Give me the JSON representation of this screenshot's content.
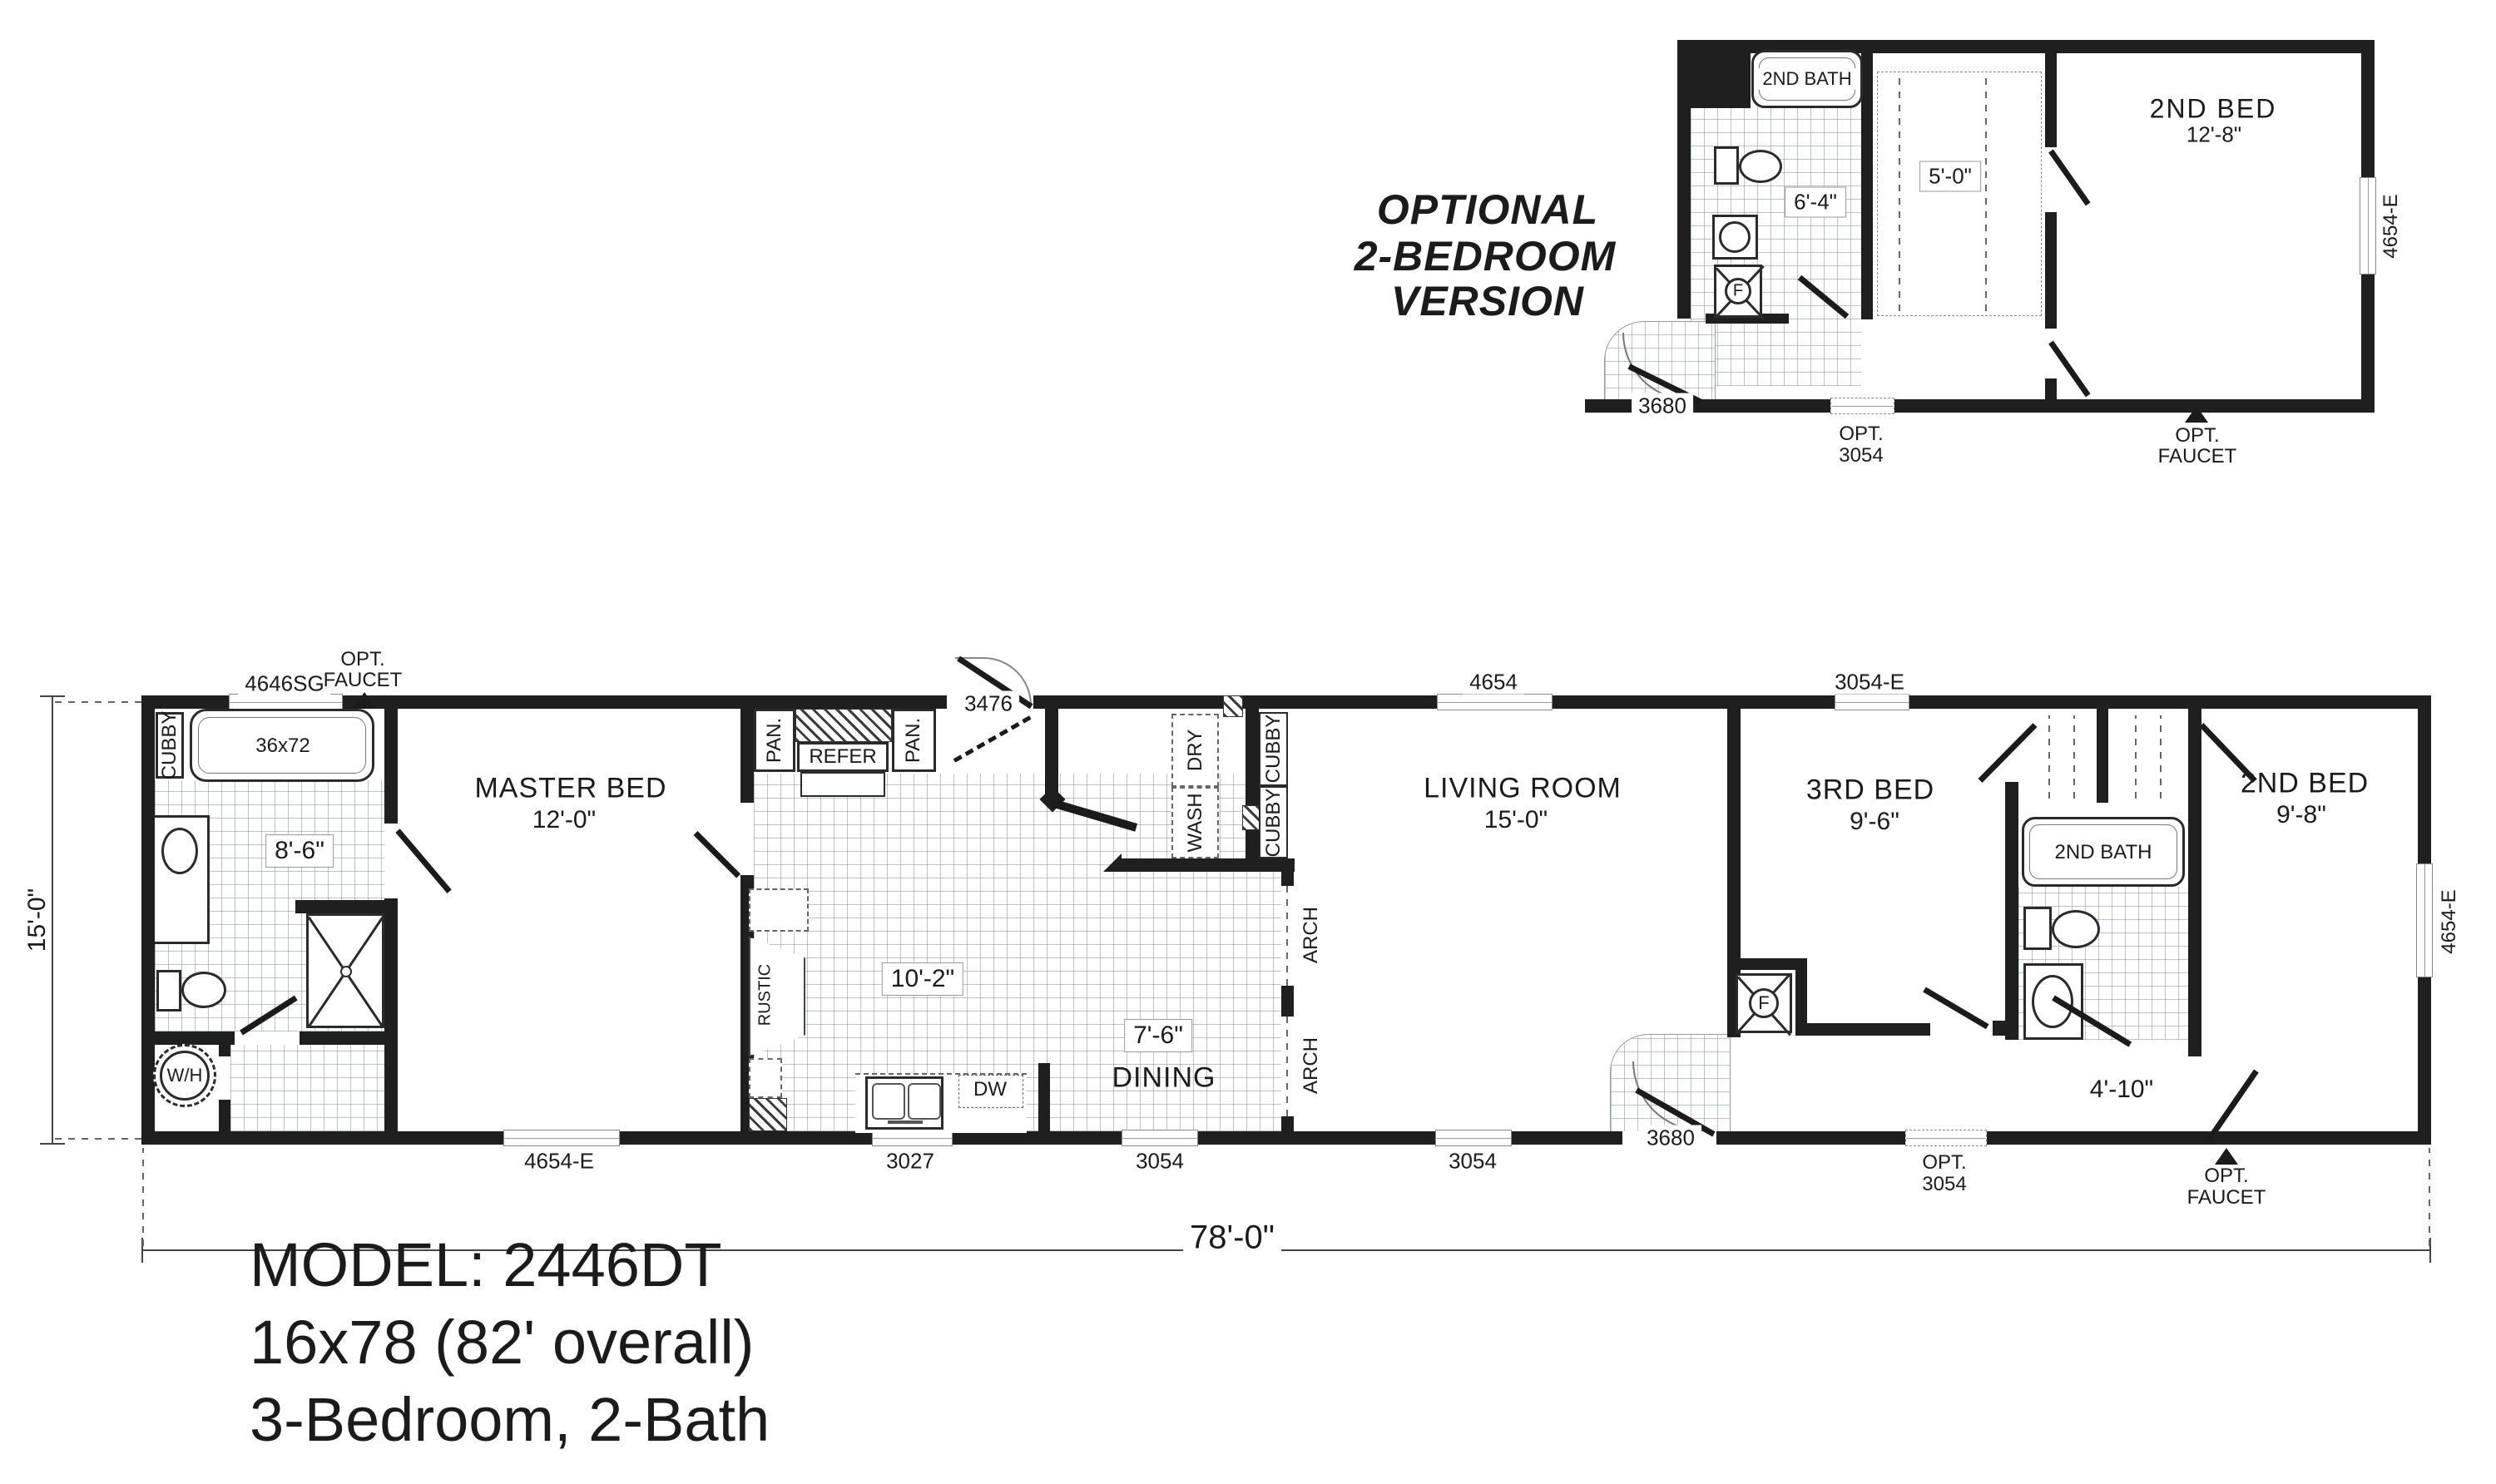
{
  "title": {
    "line1": "MODEL: 2446DT",
    "line2": "16x78 (82' overall)",
    "line3": "3-Bedroom, 2-Bath"
  },
  "optional": {
    "heading1": "OPTIONAL",
    "heading2": "2-BEDROOM",
    "heading3": "VERSION",
    "bath_label": "2ND BATH",
    "bath_dim": "6'-4\"",
    "closet_dim": "5'-0\"",
    "bed_label": "2ND BED",
    "bed_dim": "12'-8\"",
    "furnace": "F",
    "door_3680": "3680",
    "opt_window_l1": "OPT.",
    "opt_window_l2": "3054",
    "opt_faucet_l1": "OPT.",
    "opt_faucet_l2": "FAUCET",
    "window_4654e": "4654-E"
  },
  "main": {
    "opt_faucet_left_l1": "OPT.",
    "opt_faucet_left_l2": "FAUCET",
    "window_4646sg": "4646SG",
    "door_3476": "3476",
    "window_4654_top": "4654",
    "window_3054e_top": "3054-E",
    "cubby_bath": "CUBBY",
    "tub_size": "36x72",
    "bath_dim": "8'-6\"",
    "water_heater": "W/H",
    "master_label": "MASTER BED",
    "master_dim": "12'-0\"",
    "pan_left": "PAN.",
    "refer": "REFER",
    "pan_right": "PAN.",
    "kitchen_dim": "10'-2\"",
    "rustic": "RUSTIC",
    "dw": "DW",
    "dry": "DRY",
    "wash": "WASH",
    "cubby_1": "CUBBY",
    "cubby_2": "CUBBY",
    "dining_dim": "7'-6\"",
    "dining_label": "DINING",
    "arch_1": "ARCH",
    "arch_2": "ARCH",
    "living_label": "LIVING ROOM",
    "living_dim": "15'-0\"",
    "bed3_label": "3RD BED",
    "bed3_dim": "9'-6\"",
    "furnace": "F",
    "bath2_label": "2ND BATH",
    "bed2_label": "2ND BED",
    "bed2_dim": "9'-8\"",
    "hall_dim": "4'-10\"",
    "window_4654e_bottom": "4654-E",
    "window_3027": "3027",
    "window_3054_dining": "3054",
    "window_3054_living": "3054",
    "door_3680": "3680",
    "opt_window_l1": "OPT.",
    "opt_window_l2": "3054",
    "opt_faucet_right_l1": "OPT.",
    "opt_faucet_right_l2": "FAUCET",
    "window_4654e_right": "4654-E",
    "overall_width": "78'-0\"",
    "overall_depth": "15'-0\""
  }
}
